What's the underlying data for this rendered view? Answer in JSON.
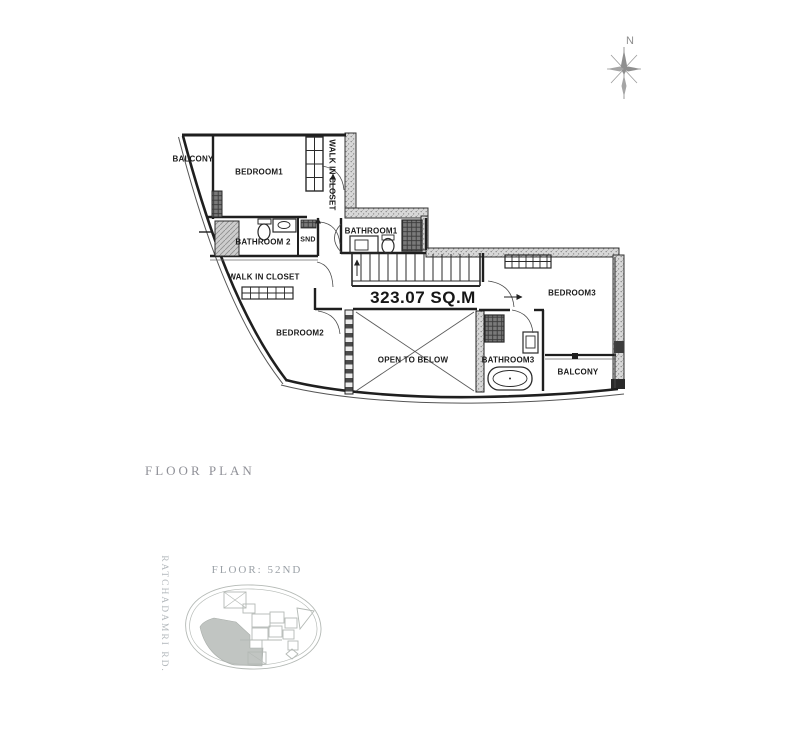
{
  "plan": {
    "area_label": "323.07 SQ.M",
    "rooms": {
      "balcony_top": "BALCONY",
      "bedroom1": "BEDROOM1",
      "walk_in_closet_1": "WALK IN CLOSET",
      "bathroom2": "BATHROOM 2",
      "snd": "SND",
      "bathroom1": "BATHROOM1",
      "walk_in_closet_2": "WALK IN CLOSET",
      "bedroom2": "BEDROOM2",
      "open_to_below": "OPEN TO BELOW",
      "bedroom3": "BEDROOM3",
      "bathroom3": "BATHROOM3",
      "balcony_bottom": "BALCONY"
    }
  },
  "compass": {
    "north_label": "N"
  },
  "caption": {
    "title": "FLOOR PLAN"
  },
  "site_map": {
    "floor_label": "FLOOR: 52ND",
    "road_label": "RATCHADAMRI RD."
  },
  "colors": {
    "wall": "#1f1f1f",
    "hatch": "#8a8a8a",
    "caption_gray": "#8f9097",
    "site_gray": "#b4b9b5",
    "unit_fill": "#b6bbb7"
  }
}
